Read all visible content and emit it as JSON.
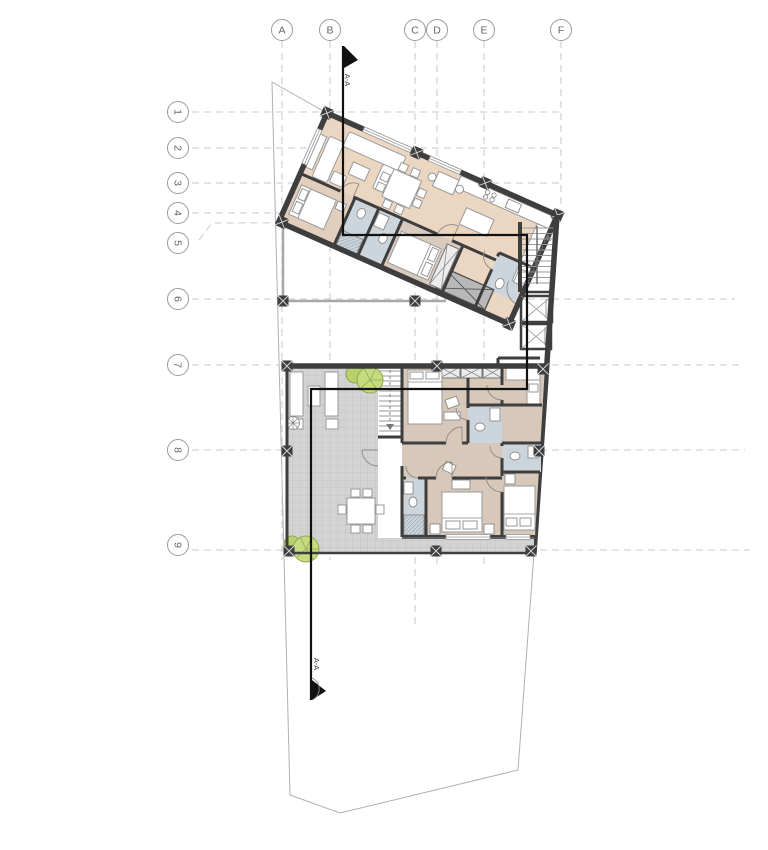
{
  "drawing": {
    "kind": "architectural floor plan",
    "section_marker": {
      "label_top": "A-A",
      "label_bottom": "A-A"
    }
  },
  "grid": {
    "columns": [
      {
        "label": "A"
      },
      {
        "label": "B"
      },
      {
        "label": "C"
      },
      {
        "label": "D"
      },
      {
        "label": "E"
      },
      {
        "label": "F"
      }
    ],
    "rows": [
      {
        "label": "1"
      },
      {
        "label": "2"
      },
      {
        "label": "3"
      },
      {
        "label": "4"
      },
      {
        "label": "5"
      },
      {
        "label": "6"
      },
      {
        "label": "7"
      },
      {
        "label": "8"
      },
      {
        "label": "9"
      }
    ]
  },
  "colors": {
    "wall": "#3e3e3e",
    "living_fill": "#ebd6c2",
    "bedroom_upper_fill": "#e2cebc",
    "bedroom_lower_fill": "#d7c8b9",
    "bathroom_fill": "#cdd5dc",
    "terrace_fill": "#d3d3d3",
    "tree_fill": "#c6da7e",
    "duct_fill": "#b8b8b8",
    "grid_line": "#c8c8c8",
    "section_line": "#111111",
    "site_boundary": "#b0b0b0"
  }
}
